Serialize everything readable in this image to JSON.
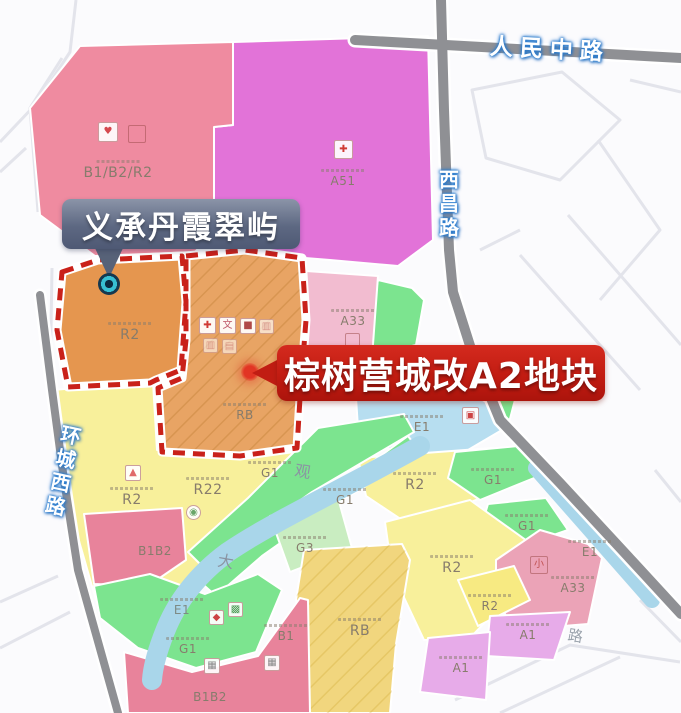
{
  "roads": {
    "renmin_zhong_lu": "人民中路",
    "xichang_lu": "西昌路",
    "huancheng_xi_lu": "环城西路",
    "partial_road_char": "路"
  },
  "river": {
    "char_da": "大",
    "char_guan": "观"
  },
  "callouts": {
    "project_name": "义承丹霞翠屿",
    "parcel_name": "棕树营城改A2地块"
  },
  "parcels": {
    "b1b2r2_nw": "B1/B2/R2",
    "a51": "A51",
    "r2_orange": "R2",
    "rb_orange": "RB",
    "a33_n": "A33",
    "r2_w": "R2",
    "r22": "R22",
    "b1b2_w": "B1B2",
    "g1_river_n": "G1",
    "g1_river_s": "G1",
    "g3": "G3",
    "e1_lake": "E1",
    "r2_e": "R2",
    "g1_e1": "G1",
    "g1_e2": "G1",
    "e1_canal": "E1",
    "a33_se": "A33",
    "r2_se": "R2",
    "r2_se_small": "R2",
    "a1_e": "A1",
    "a1_s": "A1",
    "rb_s": "RB",
    "e1_river": "E1",
    "g1_sw": "G1",
    "b1_s": "B1",
    "b1b2_s": "B1B2"
  },
  "icons": {
    "nw_facility": {
      "glyph": "♥",
      "color": "#d5484f"
    },
    "nw_box": {
      "glyph": "",
      "color": "#c98"
    },
    "hospital_cross": {
      "glyph": "✚",
      "color": "#d03a34"
    },
    "orange_cross": {
      "glyph": "✚",
      "color": "#d03a34"
    },
    "orange_wen": {
      "glyph": "文",
      "color": "#c05a6a"
    },
    "orange_dark": {
      "glyph": "■",
      "color": "#b04848"
    },
    "orange_faint": {
      "glyph": "▥",
      "color": "#d08a96"
    },
    "orange_f2": {
      "glyph": "▥",
      "color": "#d08a96"
    },
    "orange_f3": {
      "glyph": "▤",
      "color": "#d08a96"
    },
    "r2w_mark": {
      "glyph": "▲",
      "color": "#e06a68"
    },
    "r22_circle": {
      "glyph": "◉",
      "color": "#6aa66a"
    },
    "lake_mark": {
      "glyph": "▣",
      "color": "#cc4444"
    },
    "a33n_box": {
      "glyph": "",
      "color": "#b88"
    },
    "a33se_xiao": {
      "glyph": "小",
      "color": "#c05050"
    },
    "sw_red": {
      "glyph": "◆",
      "color": "#cc4444"
    },
    "sw_green": {
      "glyph": "▩",
      "color": "#4f9e58"
    },
    "qr1": {
      "glyph": "▦",
      "color": "#8a8a8a"
    },
    "qr2": {
      "glyph": "▦",
      "color": "#8a8a8a"
    }
  },
  "colors": {
    "pink": "#ef8ba0",
    "magenta": "#e273d8",
    "rose": "#f2bcd0",
    "rose2": "#eba3b7",
    "orange": "#e5964f",
    "orange2": "#e8a464",
    "yellow": "#f8f09b",
    "yellow2": "#f7ea82",
    "amber": "#f1d67e",
    "green": "#7ce48f",
    "green_pale": "#c9edc1",
    "blue": "#a9d6ea",
    "lake": "#b7def0",
    "lavender": "#e7abe9",
    "deep_pink": "#e8839b",
    "road_gray": "#8f9094",
    "red_accent": "#c9211a",
    "slate": "#596480",
    "teal": "#38bfd3"
  }
}
